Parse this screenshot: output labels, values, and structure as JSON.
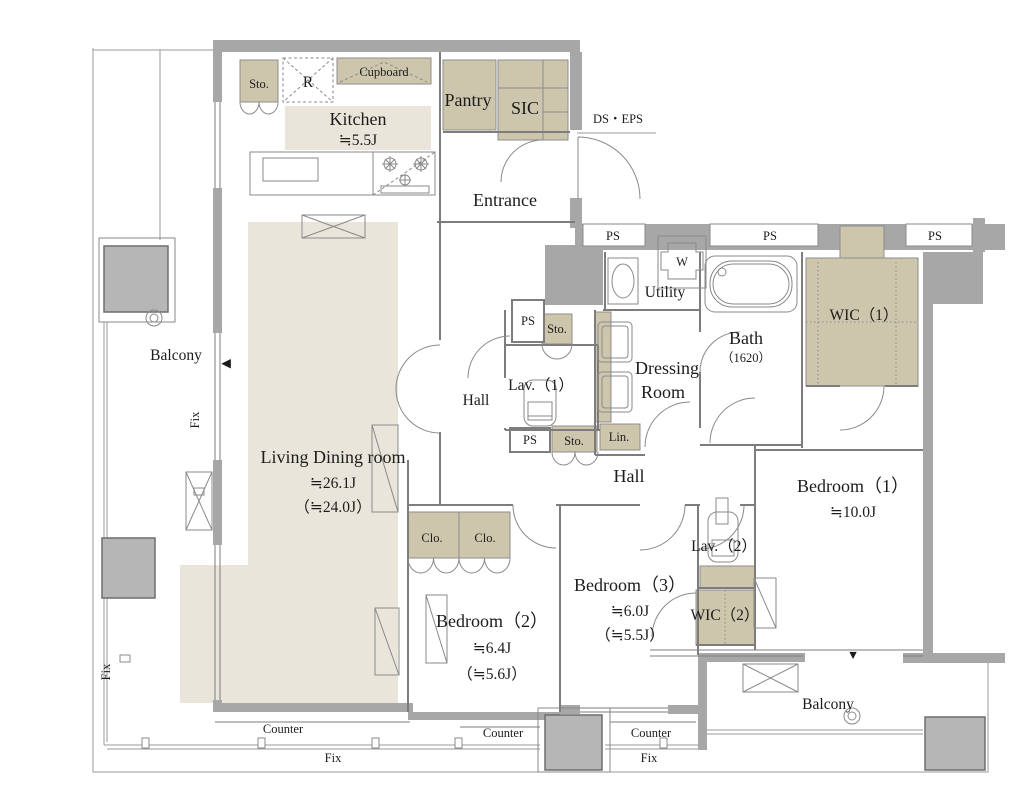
{
  "meta": {
    "type": "apartment-floor-plan"
  },
  "colors": {
    "wall_gray": "#a7a7a7",
    "pillar_gray": "#b6b6b6",
    "closet_tan": "#cdc5ac",
    "floor_beige": "#e9e5da",
    "line_gray": "#7d7d7d",
    "text": "#1c1c1c"
  },
  "rooms": {
    "kitchen": {
      "label": "Kitchen",
      "size": "≒5.5J"
    },
    "entrance": {
      "label": "Entrance"
    },
    "living": {
      "label": "Living Dining room",
      "size": "≒26.1J",
      "size2": "（≒24.0J）"
    },
    "utility": {
      "label": "Utility"
    },
    "bath": {
      "label": "Bath",
      "size": "（1620）"
    },
    "dressing": {
      "line1": "Dressing",
      "line2": "Room"
    },
    "lav1": {
      "label": "Lav.（1）"
    },
    "lav2": {
      "label": "Lav.（2）"
    },
    "wic1": {
      "label": "WIC（1）"
    },
    "wic2": {
      "label": "WIC（2）"
    },
    "bedroom1": {
      "label": "Bedroom（1）",
      "size": "≒10.0J"
    },
    "bedroom2": {
      "label": "Bedroom（2）",
      "size": "≒6.4J",
      "size2": "（≒5.6J）"
    },
    "bedroom3": {
      "label": "Bedroom（3）",
      "size": "≒6.0J",
      "size2": "（≒5.5J）"
    },
    "hall": {
      "label": "Hall"
    },
    "pantry": {
      "label": "Pantry"
    },
    "sic": {
      "label": "SIC"
    },
    "balcony": {
      "label": "Balcony"
    }
  },
  "small": {
    "sto": "Sto.",
    "clo": "Clo.",
    "lin": "Lin.",
    "ps": "PS",
    "ds_eps": "DS・EPS",
    "cupboard": "Cupboard",
    "fridge": "R",
    "washer_pan": "W",
    "counter": "Counter",
    "fix": "Fix"
  },
  "markers": {
    "entry_down": "▼",
    "entry_left": "◀"
  }
}
